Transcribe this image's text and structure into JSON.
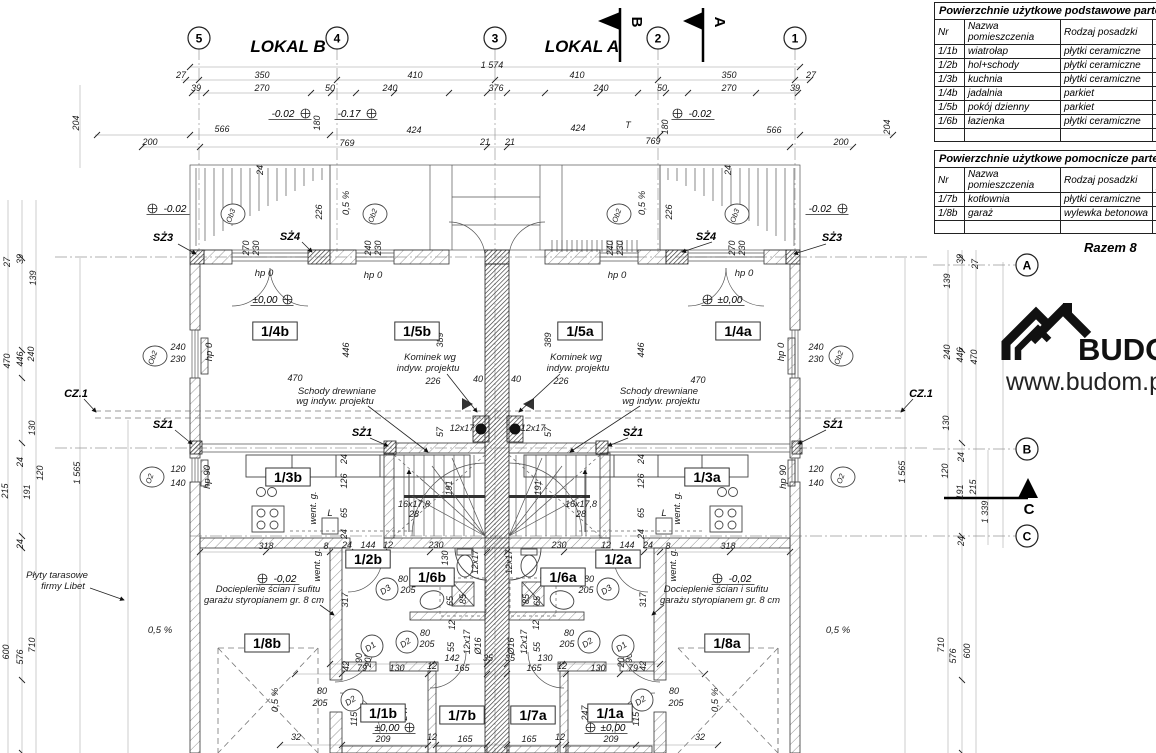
{
  "titles": {
    "lokal_b": "LOKAL B",
    "lokal_a": "LOKAL A"
  },
  "logo": {
    "brand": "BUDOM",
    "url": "www.budom.pl"
  },
  "flags": {
    "b": "B",
    "a": "A",
    "c": "C"
  },
  "panel": {
    "headers": [
      "Nr",
      "Nazwa\npomieszczenia",
      "Rodzaj posadzki",
      "Pow\n[m2"
    ],
    "tables": [
      {
        "title": "Powierzchnie użytkowe podstawowe parteru - loka",
        "rows": [
          [
            "1/1b",
            "wiatrołap",
            "płytki ceramiczne",
            ""
          ],
          [
            "1/2b",
            "hol+schody",
            "płytki ceramiczne",
            ""
          ],
          [
            "1/3b",
            "kuchnia",
            "płytki ceramiczne",
            ""
          ],
          [
            "1/4b",
            "jadalnia",
            "parkiet",
            ""
          ],
          [
            "1/5b",
            "pokój dzienny",
            "parkiet",
            ""
          ],
          [
            "1/6b",
            "łazienka",
            "płytki ceramiczne",
            ""
          ]
        ]
      },
      {
        "title": "Powierzchnie użytkowe pomocnicze parteru - loka",
        "rows": [
          [
            "1/7b",
            "kotłownia",
            "płytki ceramiczne",
            ""
          ],
          [
            "1/8b",
            "garaż",
            "wylewka betonowa",
            ""
          ]
        ]
      }
    ],
    "razem": "Razem 8"
  },
  "plan": {
    "grid_bubbles": [
      [
        "5",
        199,
        38
      ],
      [
        "4",
        337,
        38
      ],
      [
        "3",
        495,
        38
      ],
      [
        "2",
        658,
        38
      ],
      [
        "1",
        795,
        38
      ],
      [
        "A",
        1027,
        265
      ],
      [
        "B",
        1027,
        449
      ],
      [
        "C",
        1027,
        536
      ]
    ],
    "rooms": [
      [
        "1/4b",
        275,
        335
      ],
      [
        "1/5b",
        417,
        335
      ],
      [
        "1/5a",
        580,
        335
      ],
      [
        "1/4a",
        738,
        335
      ],
      [
        "1/3b",
        288,
        481
      ],
      [
        "1/3a",
        707,
        481
      ],
      [
        "1/2b",
        368,
        563
      ],
      [
        "1/2a",
        618,
        563
      ],
      [
        "1/6b",
        432,
        581
      ],
      [
        "1/6a",
        563,
        581
      ],
      [
        "1/8b",
        267,
        647
      ],
      [
        "1/8a",
        727,
        647
      ],
      [
        "1/1b",
        383,
        717
      ],
      [
        "1/7b",
        462,
        719
      ],
      [
        "1/7a",
        533,
        719
      ],
      [
        "1/1a",
        610,
        717
      ]
    ],
    "levels": [
      [
        "-0.02",
        283,
        117,
        "r"
      ],
      [
        "-0.17",
        349,
        117,
        "r"
      ],
      [
        "-0.02",
        700,
        117,
        "l"
      ],
      [
        "-0.02",
        175,
        212,
        "l"
      ],
      [
        "-0.02",
        820,
        212,
        "r"
      ],
      [
        "±0,00",
        265,
        303,
        "r"
      ],
      [
        "±0,00",
        730,
        303,
        "l"
      ],
      [
        "-0,02",
        285,
        582,
        "l"
      ],
      [
        "-0,02",
        740,
        582,
        "l"
      ],
      [
        "±0,00",
        387,
        731,
        "r"
      ],
      [
        "±0,00",
        613,
        731,
        "l"
      ]
    ],
    "window_markers": [
      [
        "Ob3",
        233,
        214
      ],
      [
        "Ob2",
        375,
        214
      ],
      [
        "Ob2",
        619,
        214
      ],
      [
        "Ob3",
        737,
        214
      ],
      [
        "Ob2",
        155,
        356
      ],
      [
        "Ob2",
        841,
        356
      ],
      [
        "O2",
        152,
        477
      ],
      [
        "O2",
        843,
        477
      ]
    ],
    "door_markers": [
      [
        "D3",
        387,
        589
      ],
      [
        "D3",
        608,
        589
      ],
      [
        "D2",
        407,
        642
      ],
      [
        "D2",
        589,
        642
      ],
      [
        "D1",
        372,
        646
      ],
      [
        "D1",
        623,
        646
      ],
      [
        "D2",
        352,
        700
      ],
      [
        "D2",
        642,
        700
      ]
    ],
    "markers": [
      [
        "SŻ3",
        163,
        241
      ],
      [
        "SŻ4",
        290,
        240
      ],
      [
        "SŻ1",
        163,
        428
      ],
      [
        "SŻ1",
        362,
        436
      ],
      [
        "SŻ1",
        633,
        436
      ],
      [
        "SŻ1",
        833,
        428
      ],
      [
        "SŻ4",
        706,
        240
      ],
      [
        "SŻ3",
        832,
        241
      ],
      [
        "CZ.1",
        76,
        397
      ],
      [
        "CZ.1",
        921,
        397
      ]
    ],
    "annotations": [
      [
        "Kominek wg",
        430,
        360
      ],
      [
        "indyw. projektu",
        428,
        371
      ],
      [
        "Kominek wg",
        576,
        360
      ],
      [
        "indyw. projektu",
        578,
        371
      ],
      [
        "Schody drewniane",
        337,
        394
      ],
      [
        "wg indyw. projektu",
        335,
        404
      ],
      [
        "Schody drewniane",
        659,
        394
      ],
      [
        "wg indyw. projektu",
        661,
        404
      ],
      [
        "Docieplenie ścian i sufitu",
        268,
        592
      ],
      [
        "garażu styropianem gr. 8 cm",
        264,
        603
      ],
      [
        "Docieplenie ścian i sufitu",
        716,
        592
      ],
      [
        "garażu styropianem gr. 8 cm",
        720,
        603
      ],
      [
        "Płyty tarasowe",
        57,
        578
      ],
      [
        "firmy Libet",
        63,
        589
      ],
      [
        "0,5 %",
        160,
        633
      ],
      [
        "0,5 %",
        838,
        633
      ],
      [
        "0,5 %",
        278,
        700,
        -90
      ],
      [
        "0,5 %",
        718,
        700,
        -90
      ],
      [
        "0,5 %",
        349,
        203,
        -90
      ],
      [
        "0,5 %",
        645,
        203,
        -90
      ],
      [
        "went. g.",
        316,
        508,
        -90
      ],
      [
        "went. g.",
        680,
        508,
        -90
      ],
      [
        "went. g.",
        320,
        565,
        -90
      ],
      [
        "went. g.",
        676,
        565,
        -90
      ],
      [
        "hp 0",
        264,
        276
      ],
      [
        "hp 0",
        373,
        278
      ],
      [
        "hp 0",
        617,
        278
      ],
      [
        "hp 0",
        744,
        276
      ],
      [
        "hp 0",
        212,
        352,
        -90
      ],
      [
        "hp 0",
        784,
        352,
        -90
      ],
      [
        "hp 90",
        210,
        477,
        -90
      ],
      [
        "hp 90",
        786,
        477,
        -90
      ],
      [
        "L",
        330,
        516
      ],
      [
        "L",
        664,
        516
      ]
    ],
    "dims": [
      [
        "1 574",
        492,
        68
      ],
      [
        "27",
        181,
        78
      ],
      [
        "350",
        262,
        78
      ],
      [
        "410",
        415,
        78
      ],
      [
        "410",
        577,
        78
      ],
      [
        "350",
        729,
        78
      ],
      [
        "27",
        811,
        78
      ],
      [
        "39",
        196,
        91
      ],
      [
        "270",
        262,
        91
      ],
      [
        "50",
        330,
        91
      ],
      [
        "240",
        390,
        91
      ],
      [
        "376",
        496,
        91
      ],
      [
        "240",
        601,
        91
      ],
      [
        "50",
        662,
        91
      ],
      [
        "270",
        729,
        91
      ],
      [
        "39",
        795,
        91
      ],
      [
        "180",
        320,
        123,
        -90
      ],
      [
        "180",
        668,
        127,
        -90
      ],
      [
        "T",
        628,
        128
      ],
      [
        "566",
        222,
        132
      ],
      [
        "424",
        414,
        133
      ],
      [
        "424",
        578,
        131
      ],
      [
        "566",
        774,
        133
      ],
      [
        "200",
        150,
        145
      ],
      [
        "769",
        347,
        146
      ],
      [
        "21",
        485,
        145
      ],
      [
        "21",
        510,
        145
      ],
      [
        "769",
        653,
        144
      ],
      [
        "200",
        841,
        145
      ],
      [
        "204",
        79,
        123,
        -90
      ],
      [
        "204",
        890,
        127,
        -90
      ],
      [
        "24",
        263,
        170,
        -90
      ],
      [
        "24",
        731,
        170,
        -90
      ],
      [
        "226",
        322,
        212,
        -90
      ],
      [
        "226",
        672,
        212,
        -90
      ],
      [
        "270",
        249,
        248,
        -90
      ],
      [
        "230",
        259,
        248,
        -90
      ],
      [
        "240",
        371,
        248,
        -90
      ],
      [
        "230",
        381,
        248,
        -90
      ],
      [
        "240",
        613,
        248,
        -90
      ],
      [
        "230",
        623,
        248,
        -90
      ],
      [
        "270",
        735,
        248,
        -90
      ],
      [
        "230",
        745,
        248,
        -90
      ],
      [
        "27",
        10,
        262,
        -90
      ],
      [
        "39",
        23,
        259,
        -90
      ],
      [
        "139",
        36,
        278,
        -90
      ],
      [
        "470",
        10,
        361,
        -90
      ],
      [
        "446",
        23,
        359,
        -90
      ],
      [
        "240",
        34,
        354,
        -90
      ],
      [
        "130",
        35,
        428,
        -90
      ],
      [
        "24",
        23,
        462,
        -90
      ],
      [
        "120",
        43,
        473,
        -90
      ],
      [
        "215",
        8,
        491,
        -90
      ],
      [
        "191",
        30,
        492,
        -90
      ],
      [
        "1 565",
        80,
        473,
        -90
      ],
      [
        "24",
        23,
        544,
        -90
      ],
      [
        "710",
        35,
        645,
        -90
      ],
      [
        "576",
        23,
        657,
        -90
      ],
      [
        "600",
        9,
        652,
        -90
      ],
      [
        "39",
        963,
        259,
        -90
      ],
      [
        "27",
        978,
        264,
        -90
      ],
      [
        "139",
        950,
        281,
        -90
      ],
      [
        "240",
        950,
        352,
        -90
      ],
      [
        "446",
        963,
        355,
        -90
      ],
      [
        "470",
        977,
        357,
        -90
      ],
      [
        "130",
        949,
        423,
        -90
      ],
      [
        "24",
        964,
        457,
        -90
      ],
      [
        "120",
        948,
        471,
        -90
      ],
      [
        "215",
        976,
        487,
        -90
      ],
      [
        "191",
        963,
        492,
        -90
      ],
      [
        "1 339",
        988,
        512,
        -90
      ],
      [
        "24",
        964,
        541,
        -90
      ],
      [
        "1 565",
        905,
        472,
        -90
      ],
      [
        "710",
        944,
        645,
        -90
      ],
      [
        "576",
        956,
        656,
        -90
      ],
      [
        "600",
        970,
        651,
        -90
      ],
      [
        "470",
        295,
        381
      ],
      [
        "470",
        698,
        383
      ],
      [
        "446",
        349,
        350,
        -90
      ],
      [
        "446",
        644,
        350,
        -90
      ],
      [
        "389",
        443,
        340,
        -90
      ],
      [
        "389",
        551,
        340,
        -90
      ],
      [
        "40",
        478,
        382
      ],
      [
        "40",
        516,
        382
      ],
      [
        "226",
        433,
        384
      ],
      [
        "226",
        561,
        384
      ],
      [
        "240",
        178,
        350
      ],
      [
        "230",
        178,
        362
      ],
      [
        "240",
        816,
        350
      ],
      [
        "230",
        816,
        362
      ],
      [
        "57",
        443,
        432,
        -90
      ],
      [
        "57",
        551,
        432,
        -90
      ],
      [
        "12x17",
        462,
        431
      ],
      [
        "12x17",
        533,
        431
      ],
      [
        "16x17,8",
        414,
        507
      ],
      [
        "28",
        414,
        517
      ],
      [
        "16x17,8",
        581,
        507
      ],
      [
        "28",
        581,
        517
      ],
      [
        "191",
        452,
        488,
        -90
      ],
      [
        "191",
        541,
        488,
        -90
      ],
      [
        "24",
        347,
        459,
        -90
      ],
      [
        "126",
        347,
        481,
        -90
      ],
      [
        "65",
        347,
        513,
        -90
      ],
      [
        "24",
        347,
        534,
        -90
      ],
      [
        "24",
        644,
        459,
        -90
      ],
      [
        "126",
        644,
        481,
        -90
      ],
      [
        "65",
        644,
        513,
        -90
      ],
      [
        "24",
        644,
        534,
        -90
      ],
      [
        "120",
        178,
        472
      ],
      [
        "140",
        178,
        486
      ],
      [
        "120",
        816,
        472
      ],
      [
        "140",
        816,
        486
      ],
      [
        "318",
        266,
        549
      ],
      [
        "8",
        326,
        549
      ],
      [
        "24",
        347,
        548
      ],
      [
        "144",
        368,
        548
      ],
      [
        "12",
        388,
        548
      ],
      [
        "230",
        436,
        548
      ],
      [
        "230",
        559,
        548
      ],
      [
        "12",
        606,
        548
      ],
      [
        "144",
        627,
        548
      ],
      [
        "24",
        648,
        548
      ],
      [
        "8",
        668,
        549
      ],
      [
        "318",
        728,
        549
      ],
      [
        "130",
        448,
        558,
        -90
      ],
      [
        "130",
        622,
        558,
        -90
      ],
      [
        "12x17",
        478,
        562,
        -90
      ],
      [
        "12x17",
        512,
        562,
        -90
      ],
      [
        "65",
        453,
        601,
        -90
      ],
      [
        "85",
        466,
        599,
        -90
      ],
      [
        "85",
        529,
        599,
        -90
      ],
      [
        "65",
        540,
        601,
        -90
      ],
      [
        "12",
        455,
        625,
        -90
      ],
      [
        "12",
        539,
        625,
        -90
      ],
      [
        "55",
        454,
        647,
        -90
      ],
      [
        "55",
        540,
        647,
        -90
      ],
      [
        "12x17",
        470,
        642,
        -90
      ],
      [
        "Ø16",
        481,
        646,
        -90
      ],
      [
        "Ø16",
        514,
        646,
        -90
      ],
      [
        "12x17",
        527,
        642,
        -90
      ],
      [
        "80",
        403,
        582
      ],
      [
        "205",
        408,
        593
      ],
      [
        "80",
        589,
        582
      ],
      [
        "205",
        586,
        593
      ],
      [
        "80",
        425,
        636
      ],
      [
        "205",
        427,
        647
      ],
      [
        "80",
        569,
        636
      ],
      [
        "205",
        567,
        647
      ],
      [
        "90",
        362,
        658,
        -90
      ],
      [
        "205",
        371,
        660,
        -90
      ],
      [
        "90",
        632,
        658,
        -90
      ],
      [
        "205",
        624,
        660,
        -90
      ],
      [
        "317",
        348,
        600,
        -90
      ],
      [
        "317",
        646,
        600,
        -90
      ],
      [
        "142",
        452,
        661
      ],
      [
        "35",
        488,
        661
      ],
      [
        "35",
        510,
        661
      ],
      [
        "130",
        545,
        661
      ],
      [
        "79",
        362,
        671
      ],
      [
        "130",
        397,
        671
      ],
      [
        "12",
        432,
        669
      ],
      [
        "165",
        462,
        671
      ],
      [
        "165",
        534,
        671
      ],
      [
        "12",
        562,
        669
      ],
      [
        "130",
        598,
        671
      ],
      [
        "79",
        633,
        671
      ],
      [
        "42",
        349,
        666,
        -90
      ],
      [
        "42",
        646,
        666,
        -90
      ],
      [
        "115",
        357,
        719,
        -90
      ],
      [
        "115",
        639,
        719,
        -90
      ],
      [
        "247",
        407,
        713,
        -90
      ],
      [
        "247",
        588,
        713,
        -90
      ],
      [
        "80",
        322,
        694
      ],
      [
        "205",
        320,
        706
      ],
      [
        "80",
        674,
        694
      ],
      [
        "205",
        676,
        706
      ],
      [
        "209",
        383,
        742
      ],
      [
        "12",
        432,
        740
      ],
      [
        "165",
        465,
        742
      ],
      [
        "165",
        529,
        742
      ],
      [
        "12",
        560,
        740
      ],
      [
        "209",
        611,
        742
      ],
      [
        "32",
        296,
        740
      ],
      [
        "32",
        700,
        740
      ]
    ]
  }
}
